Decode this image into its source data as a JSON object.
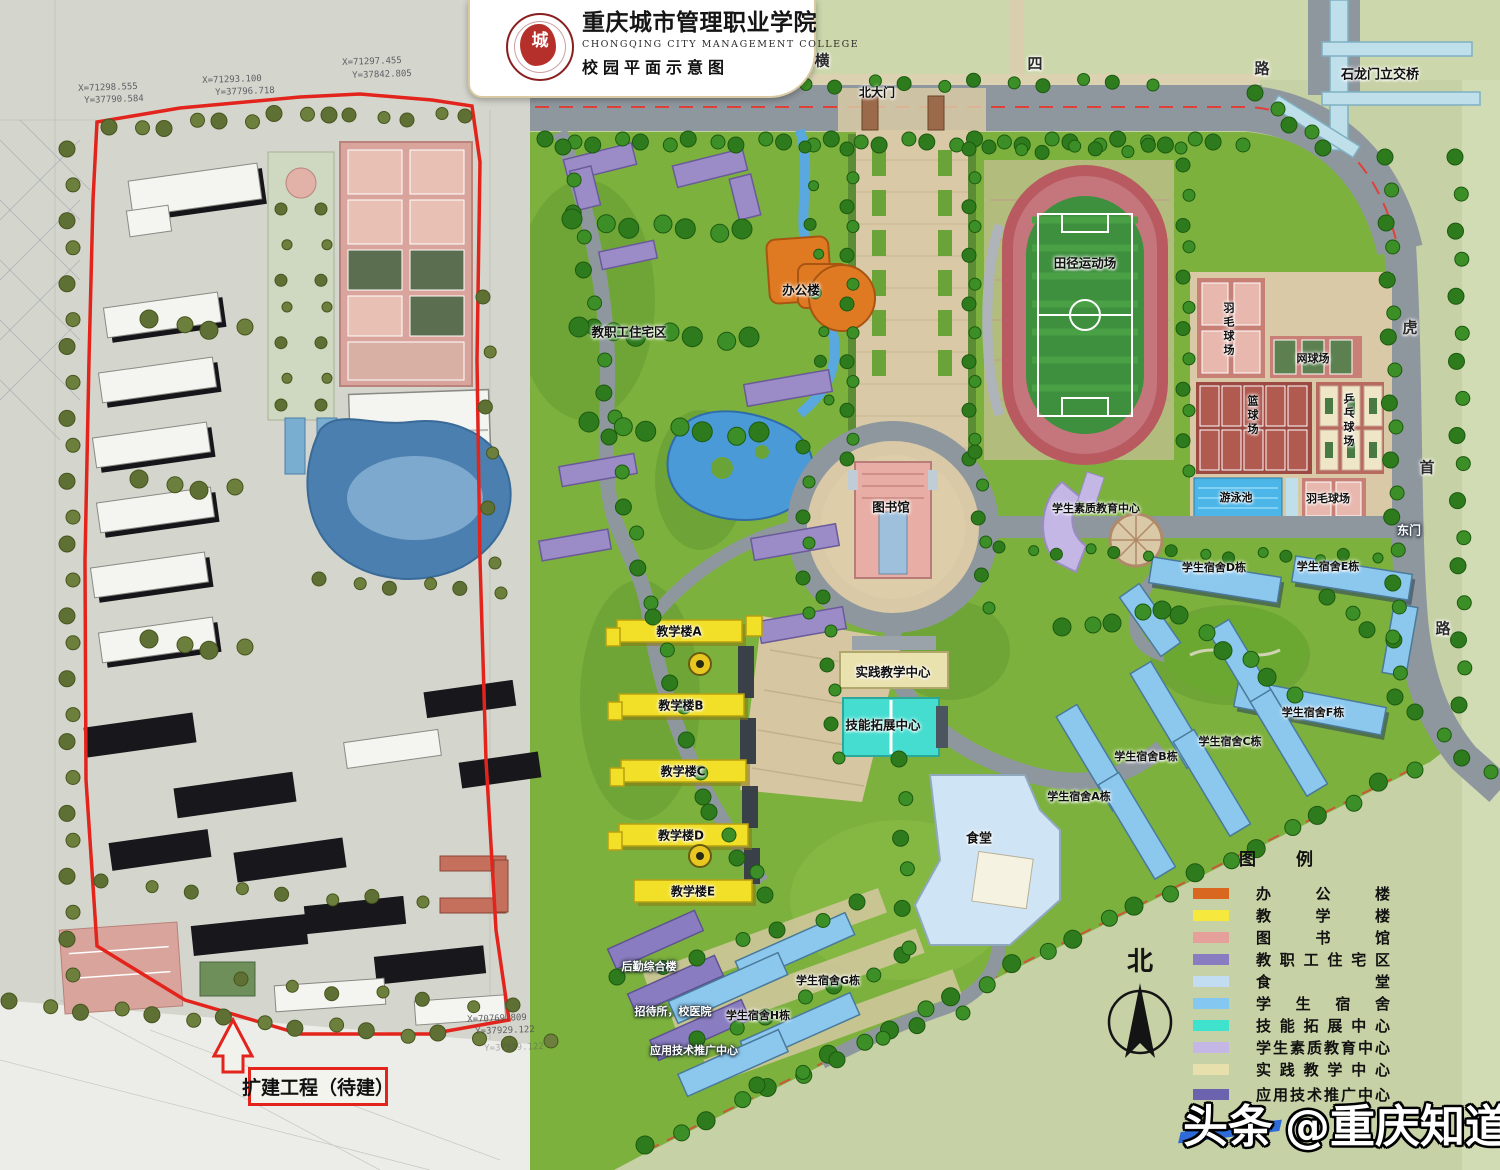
{
  "header": {
    "college_cn": "重庆城市管理职业学院",
    "college_en": "CHONGQING  CITY  MANAGEMENT  COLLEGE",
    "subtitle": "校园平面示意图",
    "seal_char": "城"
  },
  "annotation": {
    "extension": "扩建工程（待建）"
  },
  "survey_coords": {
    "c1x": "X=71298.555",
    "c1y": "Y=37790.584",
    "c2x": "X=71293.100",
    "c2y": "Y=37796.718",
    "c3x": "X=71297.455",
    "c3y": "Y=37842.805",
    "c4x": "X=70769.809",
    "c4y": "Y=37929.122",
    "c5y": "Y=37929.122"
  },
  "roads": {
    "north_road_char1": "横",
    "north_road_char2": "四",
    "north_road_char3": "路",
    "bridge": "石龙门立交桥",
    "east_road_char1": "虎",
    "east_road_char2": "首",
    "east_road_char3": "路"
  },
  "gates": {
    "north": "北大门",
    "east": "东门"
  },
  "facilities": {
    "admin": "办公楼",
    "faculty_housing": "教职工住宅区",
    "stadium": "田径运动场",
    "library": "图书馆",
    "quality_center": "学生素质教育中心",
    "practice_center": "实践教学中心",
    "skill_center": "技能拓展中心",
    "dining": "食堂",
    "pool": "游泳池",
    "badminton_top": "羽毛球场",
    "badminton_bottom": "羽毛球场",
    "tennis": "网球场",
    "basketball": "篮球场",
    "pingpong": "乒乓球场",
    "logistics": "后勤综合楼",
    "guesthouse_hospital": "招待所，校医院",
    "tech_center": "应用技术推广中心",
    "teach_a": "教学楼A",
    "teach_b": "教学楼B",
    "teach_c": "教学楼C",
    "teach_d": "教学楼D",
    "teach_e": "教学楼E",
    "dorm_a": "学生宿舍A栋",
    "dorm_b": "学生宿舍B栋",
    "dorm_c": "学生宿舍C栋",
    "dorm_d": "学生宿舍D栋",
    "dorm_e": "学生宿舍E栋",
    "dorm_f": "学生宿舍F栋",
    "dorm_g": "学生宿舍G栋",
    "dorm_h": "学生宿舍H栋"
  },
  "legend": {
    "title": "图　　例",
    "items": [
      {
        "label": "办公楼",
        "color": "#d9671f"
      },
      {
        "label": "教学楼",
        "color": "#f7e83e"
      },
      {
        "label": "图书馆",
        "color": "#e5a09c"
      },
      {
        "label": "教职工住宅区",
        "color": "#8a7cc0"
      },
      {
        "label": "食堂",
        "color": "#c2dcf2"
      },
      {
        "label": "学生宿舍",
        "color": "#84c7f0"
      },
      {
        "label": "技能拓展中心",
        "color": "#3fe2cc"
      },
      {
        "label": "学生素质教育中心",
        "color": "#c4b7e6"
      },
      {
        "label": "实践教学中心",
        "color": "#e8e0ac"
      },
      {
        "label": "应用技术推广中心",
        "color": "#6c63ae"
      }
    ]
  },
  "compass": {
    "north": "北"
  },
  "watermark": {
    "brand": "头条",
    "handle": "@重庆知道"
  }
}
